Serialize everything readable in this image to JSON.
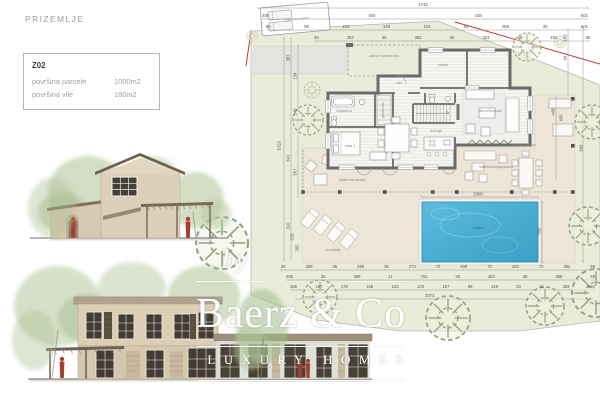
{
  "page": {
    "title": "PRIZEMLJE"
  },
  "info_box": {
    "code": "Z02",
    "rows": [
      {
        "label": "površina parcele",
        "value": "1000m2"
      },
      {
        "label": "površina vile",
        "value": "180m2"
      }
    ]
  },
  "watermark": {
    "by": "by",
    "brand": "Baerz & Co",
    "tagline": "LUXURY HOMES"
  },
  "site_plan": {
    "labels": {
      "canopy": "ulazna nadstrešnica",
      "ulaz": "ulaz",
      "ostava": "ostava",
      "kupaonica": "kupaonica",
      "garderoba": "garderoba",
      "soba1": "soba 1",
      "kuhinja": "kuhinja",
      "dnevni": "dnevni boravak",
      "terasa": "natkrivena terasa",
      "vanjska_kuhinja": "vanjska kuhinja",
      "blagovaona": "natkrivena blagovaona",
      "suncaliste": "sunčalište",
      "bazen": "bazen",
      "parking": "2 parkirna mjesta"
    },
    "dims": {
      "top_total": "1742",
      "top_row_2": [
        "400",
        "400",
        "438",
        "501"
      ],
      "top_row_3": [
        "88",
        "88",
        "229",
        "148",
        "103",
        "88",
        "900",
        "35",
        "501"
      ],
      "top_row_4": [
        "36",
        "363",
        "36",
        "362",
        "36",
        "363",
        "46",
        "454",
        "36"
      ],
      "bottom_row_1": [
        "35",
        "258",
        "35",
        "255",
        "35",
        "273",
        "70",
        "409",
        "70",
        "420",
        "70",
        "382",
        "69"
      ],
      "bottom_row_2": [
        "209",
        "35",
        "389",
        "11",
        "762",
        "35",
        "463",
        "35",
        "368",
        "69"
      ],
      "bottom_row_3": [
        "159",
        "187",
        "178",
        "158",
        "123",
        "133",
        "157",
        "95",
        "149",
        "53",
        "41",
        "383",
        "534"
      ],
      "bottom_total": "2373",
      "left": [
        "387",
        "154",
        "148",
        "1029",
        "641",
        "567",
        "310",
        "319",
        "282"
      ],
      "right": [
        "183",
        "94",
        "448",
        "406",
        "608"
      ],
      "pool_width": "1000",
      "pool_depth": "550"
    },
    "colors": {
      "lot": "#e9ecd9",
      "terrace": "#ece5d8",
      "pool": "#49aed2",
      "boundary_red": "#c0392b",
      "walls": "#6a6a6a",
      "elevation_wall": "#d9cbb4",
      "figure_red": "#a63f2e"
    }
  }
}
